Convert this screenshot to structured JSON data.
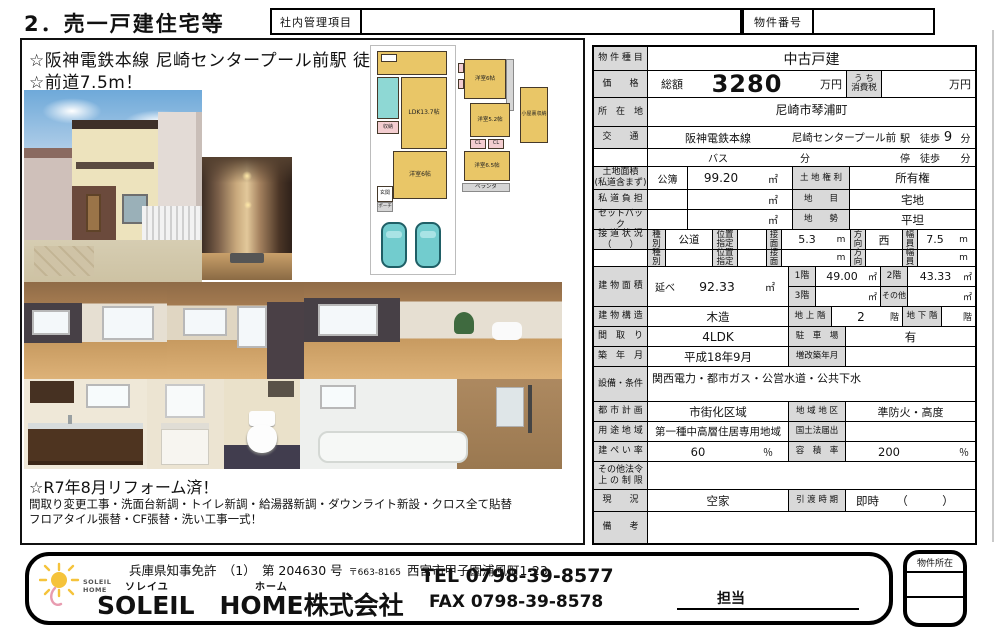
{
  "page": {
    "title": "2．売一戸建住宅等",
    "internal_label": "社内管理項目",
    "property_no_label": "物件番号"
  },
  "colors": {
    "label_bg": "#d9d9d9",
    "floorplan_room": "#e9c667",
    "floorplan_closet": "#f3cdd0",
    "floorplan_bath": "#8ed8d4",
    "car": "#72ccce",
    "logo_sun": "#f5c33b"
  },
  "left": {
    "catch1": "☆阪神電鉄本線 尼崎センタープール前駅 徒歩9分！",
    "catch2": "☆前道7.5m！",
    "reform_title": "☆R7年8月リフォーム済！",
    "reform_line1": "間取り変更工事・洗面台新調・トイレ新調・給湯器新調・ダウンライト新設・クロス全て貼替",
    "reform_line2": "フロアタイル張替・CF張替・洗い工事一式！",
    "floorplan": {
      "ldk": "LDK13.7帖",
      "room1f": "洋室6帖",
      "storage": "収納",
      "genkan": "玄関",
      "porch": "ポーチ",
      "room2f_a": "洋室6帖",
      "room2f_b": "洋室5.2帖",
      "room2f_c": "洋室6.5帖",
      "cl": "CL",
      "veranda": "ベランダ",
      "attic": "小屋裏収納"
    }
  },
  "table": {
    "type": {
      "label": "物 件 種 目",
      "value": "中古戸建"
    },
    "price": {
      "label": "価　　格",
      "prefix": "総額",
      "value": "3280",
      "unit": "万円",
      "tax_label": "う ち\n消費税",
      "tax_value": "",
      "tax_unit": "万円"
    },
    "location": {
      "label": "所　在　地",
      "value": "尼崎市琴浦町"
    },
    "traffic": {
      "label": "交　　通",
      "line": "阪神電鉄本線",
      "station": "尼崎センタープール前",
      "walk": "駅　徒歩",
      "walk_min": "9",
      "min_unit": "分",
      "bus": "バス",
      "bus_unit": "分",
      "stop": "停　徒歩",
      "stop_unit": "分"
    },
    "land": {
      "label": "土地面積\n(私道含まず)",
      "kobo": "公簿",
      "value": "99.20",
      "unit": "㎡",
      "right_label": "土 地 権 利",
      "right_value": "所有権"
    },
    "private_road": {
      "label": "私 道 負 担",
      "value": "",
      "unit": "㎡",
      "right_label": "地　　目",
      "right_value": "宅地"
    },
    "setback": {
      "label": "セットバック",
      "value": "",
      "unit": "㎡",
      "right_label": "地　　勢",
      "right_value": "平坦"
    },
    "road": {
      "label": "接 道 状 況\n（　　）",
      "type_label": "種\n別",
      "pos_label": "位置\n指定",
      "face_label": "接\n面",
      "dir_label": "方\n向",
      "width_label": "幅\n員",
      "r1": {
        "type": "公道",
        "pos": "",
        "face": "5.3",
        "m": "m",
        "dir": "西",
        "width": "7.5",
        "m2": "m"
      },
      "r2": {
        "type": "",
        "pos": "",
        "face": "",
        "m": "m",
        "dir": "",
        "width": "",
        "m2": "m"
      }
    },
    "building_area": {
      "label": "建 物 面 積",
      "nobe": "延べ",
      "value": "92.33",
      "unit": "㎡",
      "f1_label": "1階",
      "f1": "49.00",
      "f1_unit": "㎡",
      "f2_label": "2階",
      "f2": "43.33",
      "f2_unit": "㎡",
      "f3_label": "3階",
      "f3": "",
      "f3_unit": "㎡",
      "other_label": "その他",
      "other": "",
      "other_unit": "㎡"
    },
    "structure": {
      "label": "建 物 構 造",
      "value": "木造",
      "above_label": "地 上 階",
      "above": "2",
      "above_unit": "階",
      "below_label": "地 下 階",
      "below": "",
      "below_unit": "階"
    },
    "layout": {
      "label": "間　取　り",
      "value": "4LDK",
      "right_label": "駐　車　場",
      "right_value": "有"
    },
    "built": {
      "label": "築　年　月",
      "value": "平成18年9月",
      "right_label": "増改築年月",
      "right_value": ""
    },
    "facilities": {
      "label": "設備・条件",
      "value": "関西電力・都市ガス・公営水道・公共下水"
    },
    "city_plan": {
      "label": "都 市 計 画",
      "value": "市街化区域",
      "right_label": "地 域 地 区",
      "right_value": "準防火・高度"
    },
    "zoning": {
      "label": "用 途 地 域",
      "value": "第一種中高層住居専用地域",
      "right_label": "国土法届出",
      "right_value": ""
    },
    "coverage": {
      "label": "建 ぺ い 率",
      "value": "60",
      "unit": "％",
      "right_label": "容　積　率",
      "right_value": "200",
      "right_unit": "％"
    },
    "other_law": {
      "label": "その他法令\n上 の 制 限",
      "value": ""
    },
    "status": {
      "label": "現　　況",
      "value": "空家",
      "right_label": "引 渡 時 期",
      "right_value": "即時　　（　　　）"
    },
    "remarks": {
      "label": "備　　考",
      "value": ""
    }
  },
  "footer": {
    "license": "兵庫県知事免許　（1）　第 204630 号",
    "postal": "〒663-8165",
    "address": "西宮市甲子園浦風町1-23",
    "furigana_soleil": "ソレイユ",
    "furigana_home": "ホーム",
    "company": "SOLEIL　HOME株式会社",
    "tel": "TEL 0798-39-8577",
    "fax": "FAX 0798-39-8578",
    "tanto": "担当",
    "location_box_label": "物件所在",
    "logo_line1": "SOLEIL",
    "logo_line2": "HOME"
  }
}
